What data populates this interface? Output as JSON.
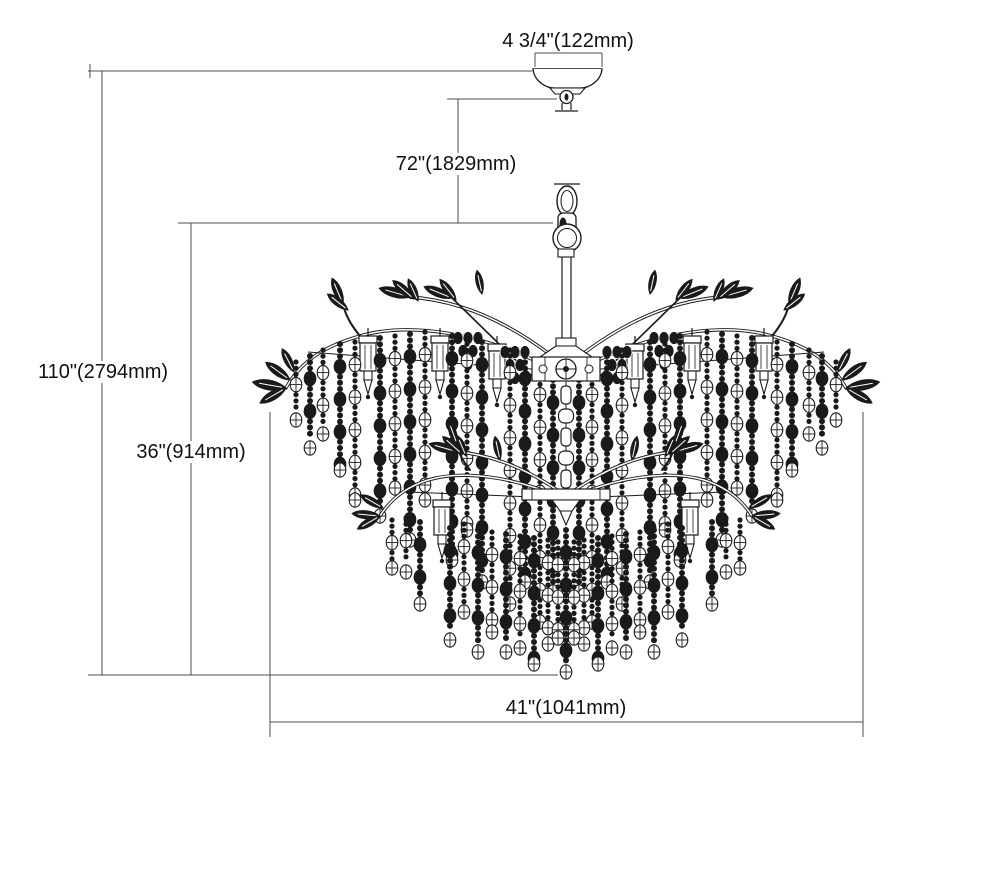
{
  "diagram": {
    "type": "chandelier-installation-dimension-drawing",
    "labels": {
      "canopy_width": "4 3/4\"(122mm)",
      "hanging_height": "72\"(1829mm)",
      "overall_height": "110\"(2794mm)",
      "fixture_height": "36\"(914mm)",
      "fixture_width": "41\"(1041mm)"
    },
    "colors": {
      "background": "#ffffff",
      "line": "#1a1a1a",
      "dimension_line": "#4d4d4d",
      "text": "#111111"
    }
  }
}
